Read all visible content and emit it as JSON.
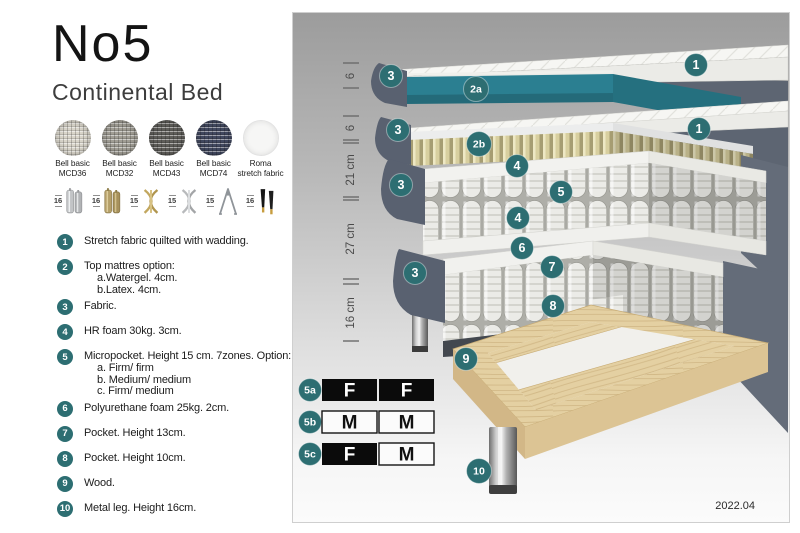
{
  "title": "No5",
  "subtitle": "Continental Bed",
  "fabrics": [
    {
      "line1": "Bell basic",
      "line2": "MCD36"
    },
    {
      "line1": "Bell basic",
      "line2": "MCD32"
    },
    {
      "line1": "Bell basic",
      "line2": "MCD43"
    },
    {
      "line1": "Bell basic",
      "line2": "MCD74"
    },
    {
      "line1": "Roma",
      "line2": "stretch fabric"
    }
  ],
  "legs": [
    {
      "size": "16",
      "name": "cylinder-chrome-leg"
    },
    {
      "size": "16",
      "name": "cylinder-brass-leg"
    },
    {
      "size": "15",
      "name": "twist-gold-leg"
    },
    {
      "size": "15",
      "name": "twist-silver-leg"
    },
    {
      "size": "15",
      "name": "hairpin-leg"
    },
    {
      "size": "16",
      "name": "tapered-black-gold-leg"
    }
  ],
  "list": [
    {
      "num": "1",
      "text": "Stretch fabric quilted with wadding."
    },
    {
      "num": "2",
      "text": "Top mattres option:",
      "sub": [
        "a.Watergel. 4cm.",
        "b.Latex. 4cm."
      ]
    },
    {
      "num": "3",
      "text": "Fabric."
    },
    {
      "num": "4",
      "text": "HR foam 30kg. 3cm."
    },
    {
      "num": "5",
      "text": "Micropocket. Height 15 cm. 7zones. Option:",
      "sub": [
        "a. Firm/ firm",
        "b. Medium/ medium",
        "c. Firm/ medium"
      ]
    },
    {
      "num": "6",
      "text": "Polyurethane foam 25kg. 2cm."
    },
    {
      "num": "7",
      "text": "Pocket. Height 13cm."
    },
    {
      "num": "8",
      "text": "Pocket. Height 10cm."
    },
    {
      "num": "9",
      "text": "Wood."
    },
    {
      "num": "10",
      "text": "Metal leg. Height 16cm."
    }
  ],
  "diagram": {
    "dimensions": [
      "6",
      "6",
      "21 cm",
      "27 cm",
      "16 cm"
    ],
    "callouts": {
      "c3a": "3",
      "c1a": "1",
      "c2a": "2a",
      "c3b": "3",
      "c1b": "1",
      "c2b": "2b",
      "c4a": "4",
      "c5": "5",
      "c3c": "3",
      "c4b": "4",
      "c6": "6",
      "c3d": "3",
      "c7": "7",
      "c8": "8",
      "c9": "9",
      "c10": "10"
    },
    "firmness_table": [
      {
        "id": "5a",
        "left": "F",
        "right": "F"
      },
      {
        "id": "5b",
        "left": "M",
        "right": "M"
      },
      {
        "id": "5c",
        "left": "F",
        "right": "M"
      }
    ],
    "version": "2022.04"
  },
  "colors": {
    "badge_teal": "#2d6e72",
    "watergel_teal": "#2b7f91",
    "fabric_grey": "#5d6572",
    "latex_beige": "#d8cf9f",
    "wood": "#e4d0a2"
  }
}
